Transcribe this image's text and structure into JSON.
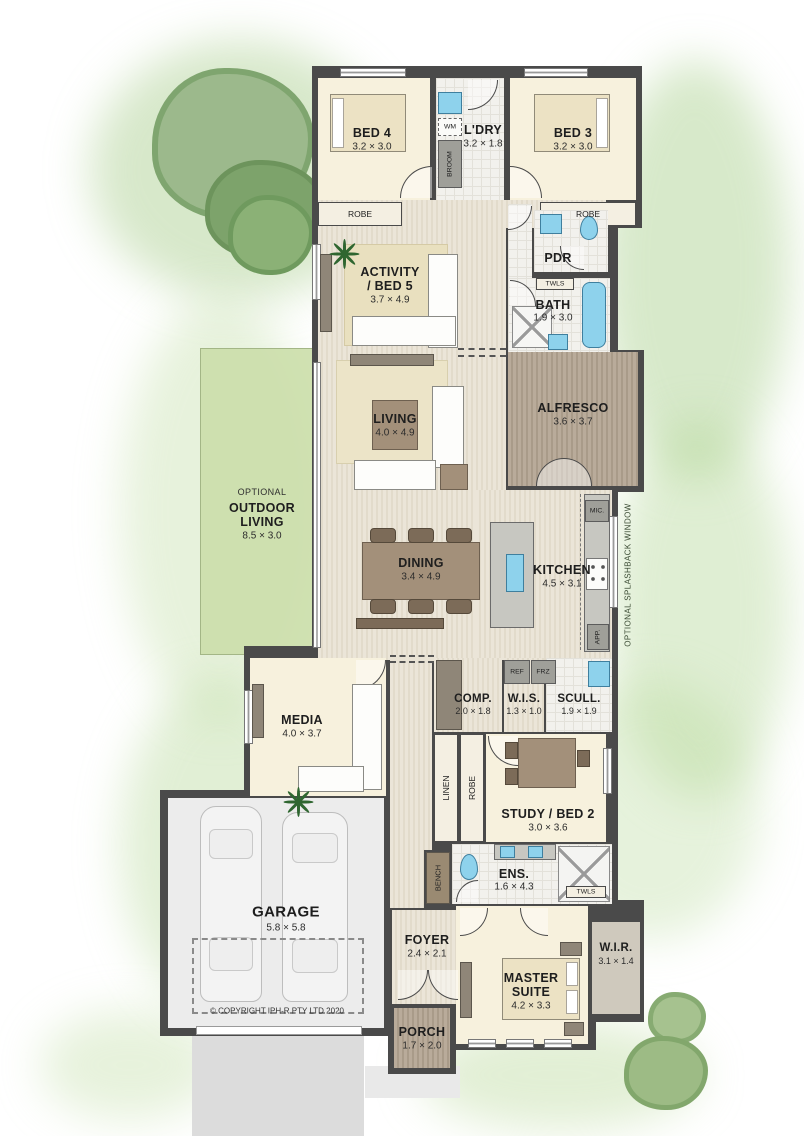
{
  "plan": {
    "copyright": "©  COPYRIGHT IPH-R PTY LTD 2020",
    "rooms": {
      "bed4": {
        "name": "BED 4",
        "dim": "3.2 × 3.0"
      },
      "ldry": {
        "name": "L'DRY",
        "dim": "3.2 × 1.8"
      },
      "bed3": {
        "name": "BED 3",
        "dim": "3.2 × 3.0"
      },
      "activity": {
        "name1": "ACTIVITY",
        "name2": "/ BED 5",
        "dim": "3.7 × 4.9"
      },
      "pdr": {
        "name": "PDR"
      },
      "bath": {
        "name": "BATH",
        "dim": "1.9 × 3.0"
      },
      "living": {
        "name": "LIVING",
        "dim": "4.0 × 4.9"
      },
      "alfresco": {
        "name": "ALFRESCO",
        "dim": "3.6 × 3.7"
      },
      "outdoor": {
        "pre": "OPTIONAL",
        "name1": "OUTDOOR",
        "name2": "LIVING",
        "dim": "8.5 × 3.0"
      },
      "dining": {
        "name": "DINING",
        "dim": "3.4 × 4.9"
      },
      "kitchen": {
        "name": "KITCHEN",
        "dim": "4.5 × 3.1"
      },
      "media": {
        "name": "MEDIA",
        "dim": "4.0 × 3.7"
      },
      "comp": {
        "name": "COMP.",
        "dim": "2.0 × 1.8"
      },
      "wis": {
        "name": "W.I.S.",
        "dim": "1.3 × 1.0"
      },
      "scull": {
        "name": "SCULL.",
        "dim": "1.9 × 1.9"
      },
      "study": {
        "name": "STUDY / BED 2",
        "dim": "3.0 × 3.6"
      },
      "ens": {
        "name": "ENS.",
        "dim": "1.6 × 4.3"
      },
      "garage": {
        "name": "GARAGE",
        "dim": "5.8 × 5.8"
      },
      "foyer": {
        "name": "FOYER",
        "dim": "2.4 × 2.1"
      },
      "master": {
        "name1": "MASTER",
        "name2": "SUITE",
        "dim": "4.2 × 3.3"
      },
      "wir": {
        "name": "W.I.R.",
        "dim": "3.1 × 1.4"
      },
      "porch": {
        "name": "PORCH",
        "dim": "1.7 × 2.0"
      }
    },
    "fixtures": {
      "robe_bed4": "ROBE",
      "robe_bed3": "ROBE",
      "wm": "WM",
      "broom": "BROOM",
      "twls_bath": "TWLS",
      "twls_ens": "TWLS",
      "mic": "MIC.",
      "app": "APP.",
      "ref": "REF",
      "frz": "FRZ",
      "linen": "LINEN",
      "robe_hall": "ROBE",
      "bench": "BENCH",
      "splashback_note": "OPTIONAL SPLASHBACK WINDOW"
    },
    "colors": {
      "wall": "#4a4a4a",
      "cream_floor": "#f7f1dd",
      "deck": "#b0a494",
      "optional_area_green": "#cbdeaa",
      "water_fixture_blue": "#8ed2ec"
    }
  }
}
